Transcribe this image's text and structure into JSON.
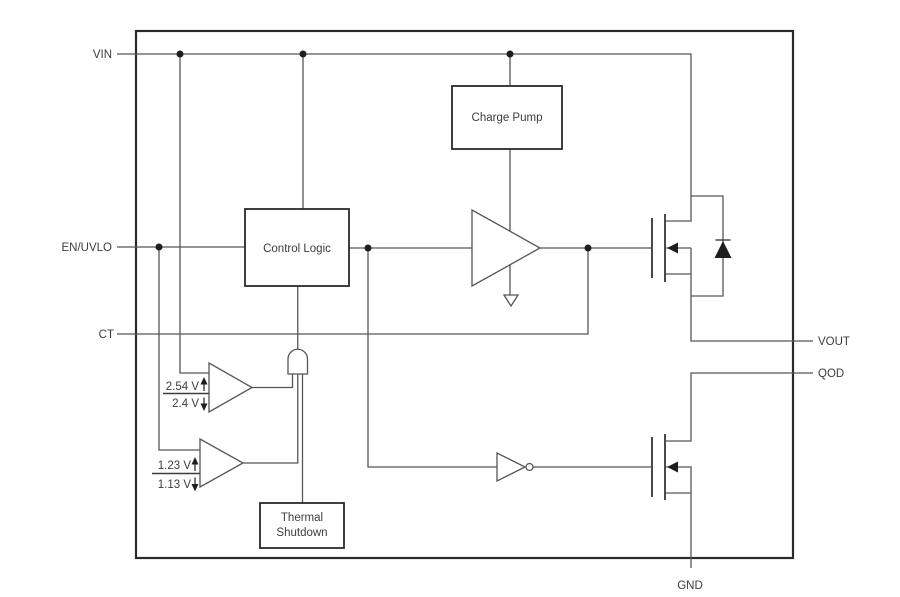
{
  "diagram": {
    "title": "load-switch-functional-block-diagram",
    "pins": {
      "vin": "VIN",
      "en_uvlo": "EN/UVLO",
      "ct": "CT",
      "vout": "VOUT",
      "qod": "QOD",
      "gnd": "GND"
    },
    "blocks": {
      "charge_pump": "Charge Pump",
      "control_logic": "Control Logic",
      "thermal_shutdown_line1": "Thermal",
      "thermal_shutdown_line2": "Shutdown"
    },
    "comparators": {
      "vin_uvlo_rising": "2.54 V",
      "vin_uvlo_falling": "2.4 V",
      "en_rising": "1.23 V",
      "en_falling": "1.13 V"
    },
    "colors": {
      "background": "#ffffff",
      "wire": "#56565a",
      "block_border": "#2a2a2c",
      "text": "#3d3d3f",
      "junction": "#1e1e20"
    }
  }
}
